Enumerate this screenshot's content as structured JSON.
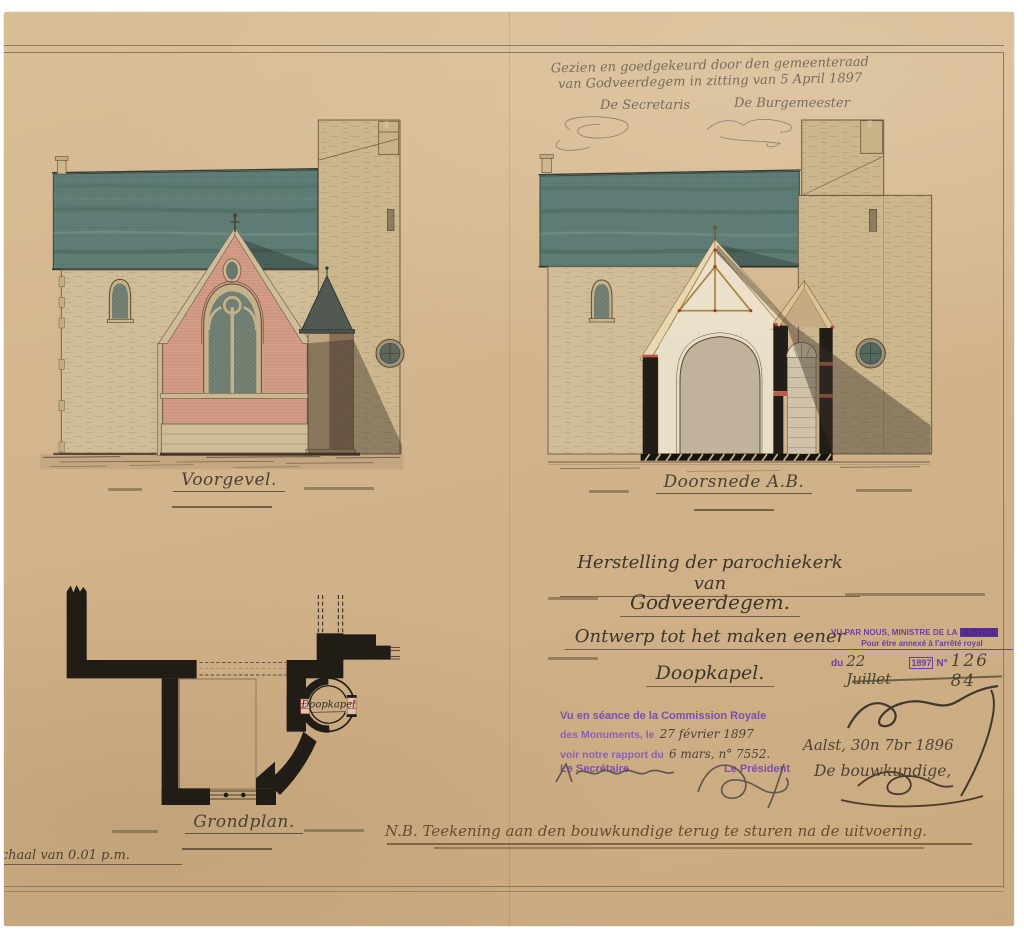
{
  "palette": {
    "paper": "#d2b48c",
    "roof_slate": "#5e7d75",
    "brick_pink": "#d29c87",
    "stone": "#d0bd98",
    "cut_wall_black": "#221d17",
    "stamp_violet": "#6b3fa6",
    "commission_violet": "#7b4fae",
    "ink": "#3d362c",
    "pencil": "#776d5e",
    "brown_ink": "#6b4a30"
  },
  "approval": {
    "line1": "Gezien en goedgekeurd door den gemeenteraad",
    "line2": "van Godveerdegem in zitting van 5 April 1897",
    "secretary_label": "De Secretaris",
    "mayor_label": "De Burgemeester"
  },
  "title_block": {
    "line1": "Herstelling der parochiekerk van",
    "line2": "Godveerdegem.",
    "line3": "Ontwerp tot het maken eener",
    "line4": "Doopkapel."
  },
  "captions": {
    "elevation": "Voorgevel.",
    "section": "Doorsnede A.B.",
    "plan": "Grondplan.",
    "plan_room": "Doopkapel",
    "scale_note": "Schaal van 0.01 p.m."
  },
  "ministry_stamp": {
    "line1a": "VU PAR NOUS, MINISTRE DE LA",
    "line1b": "JUSTICE",
    "line2": "Pour être annexé à l'arrêté royal",
    "line3_prefix": "du",
    "line3_date": "22 Juillet",
    "line3_year": "1897",
    "line3_no_label": "N°",
    "line3_number": "126 84"
  },
  "commission_stamp": {
    "line1": "Vu en séance de la Commission Royale",
    "line2_stamp": "des Monuments, le",
    "line2_script": "27 février 1897",
    "line3_stamp": "voir notre rapport du",
    "line3_script": "6 mars, n° 7552.",
    "secretary_label": "Le Secrétaire",
    "president_label": "Le Président"
  },
  "architect_block": {
    "place_date": "Aalst, 30n 7br 1896",
    "role": "De bouwkundige,"
  },
  "footer_note": "N.B. Teekening aan den bouwkundige terug te sturen na de uitvoering."
}
